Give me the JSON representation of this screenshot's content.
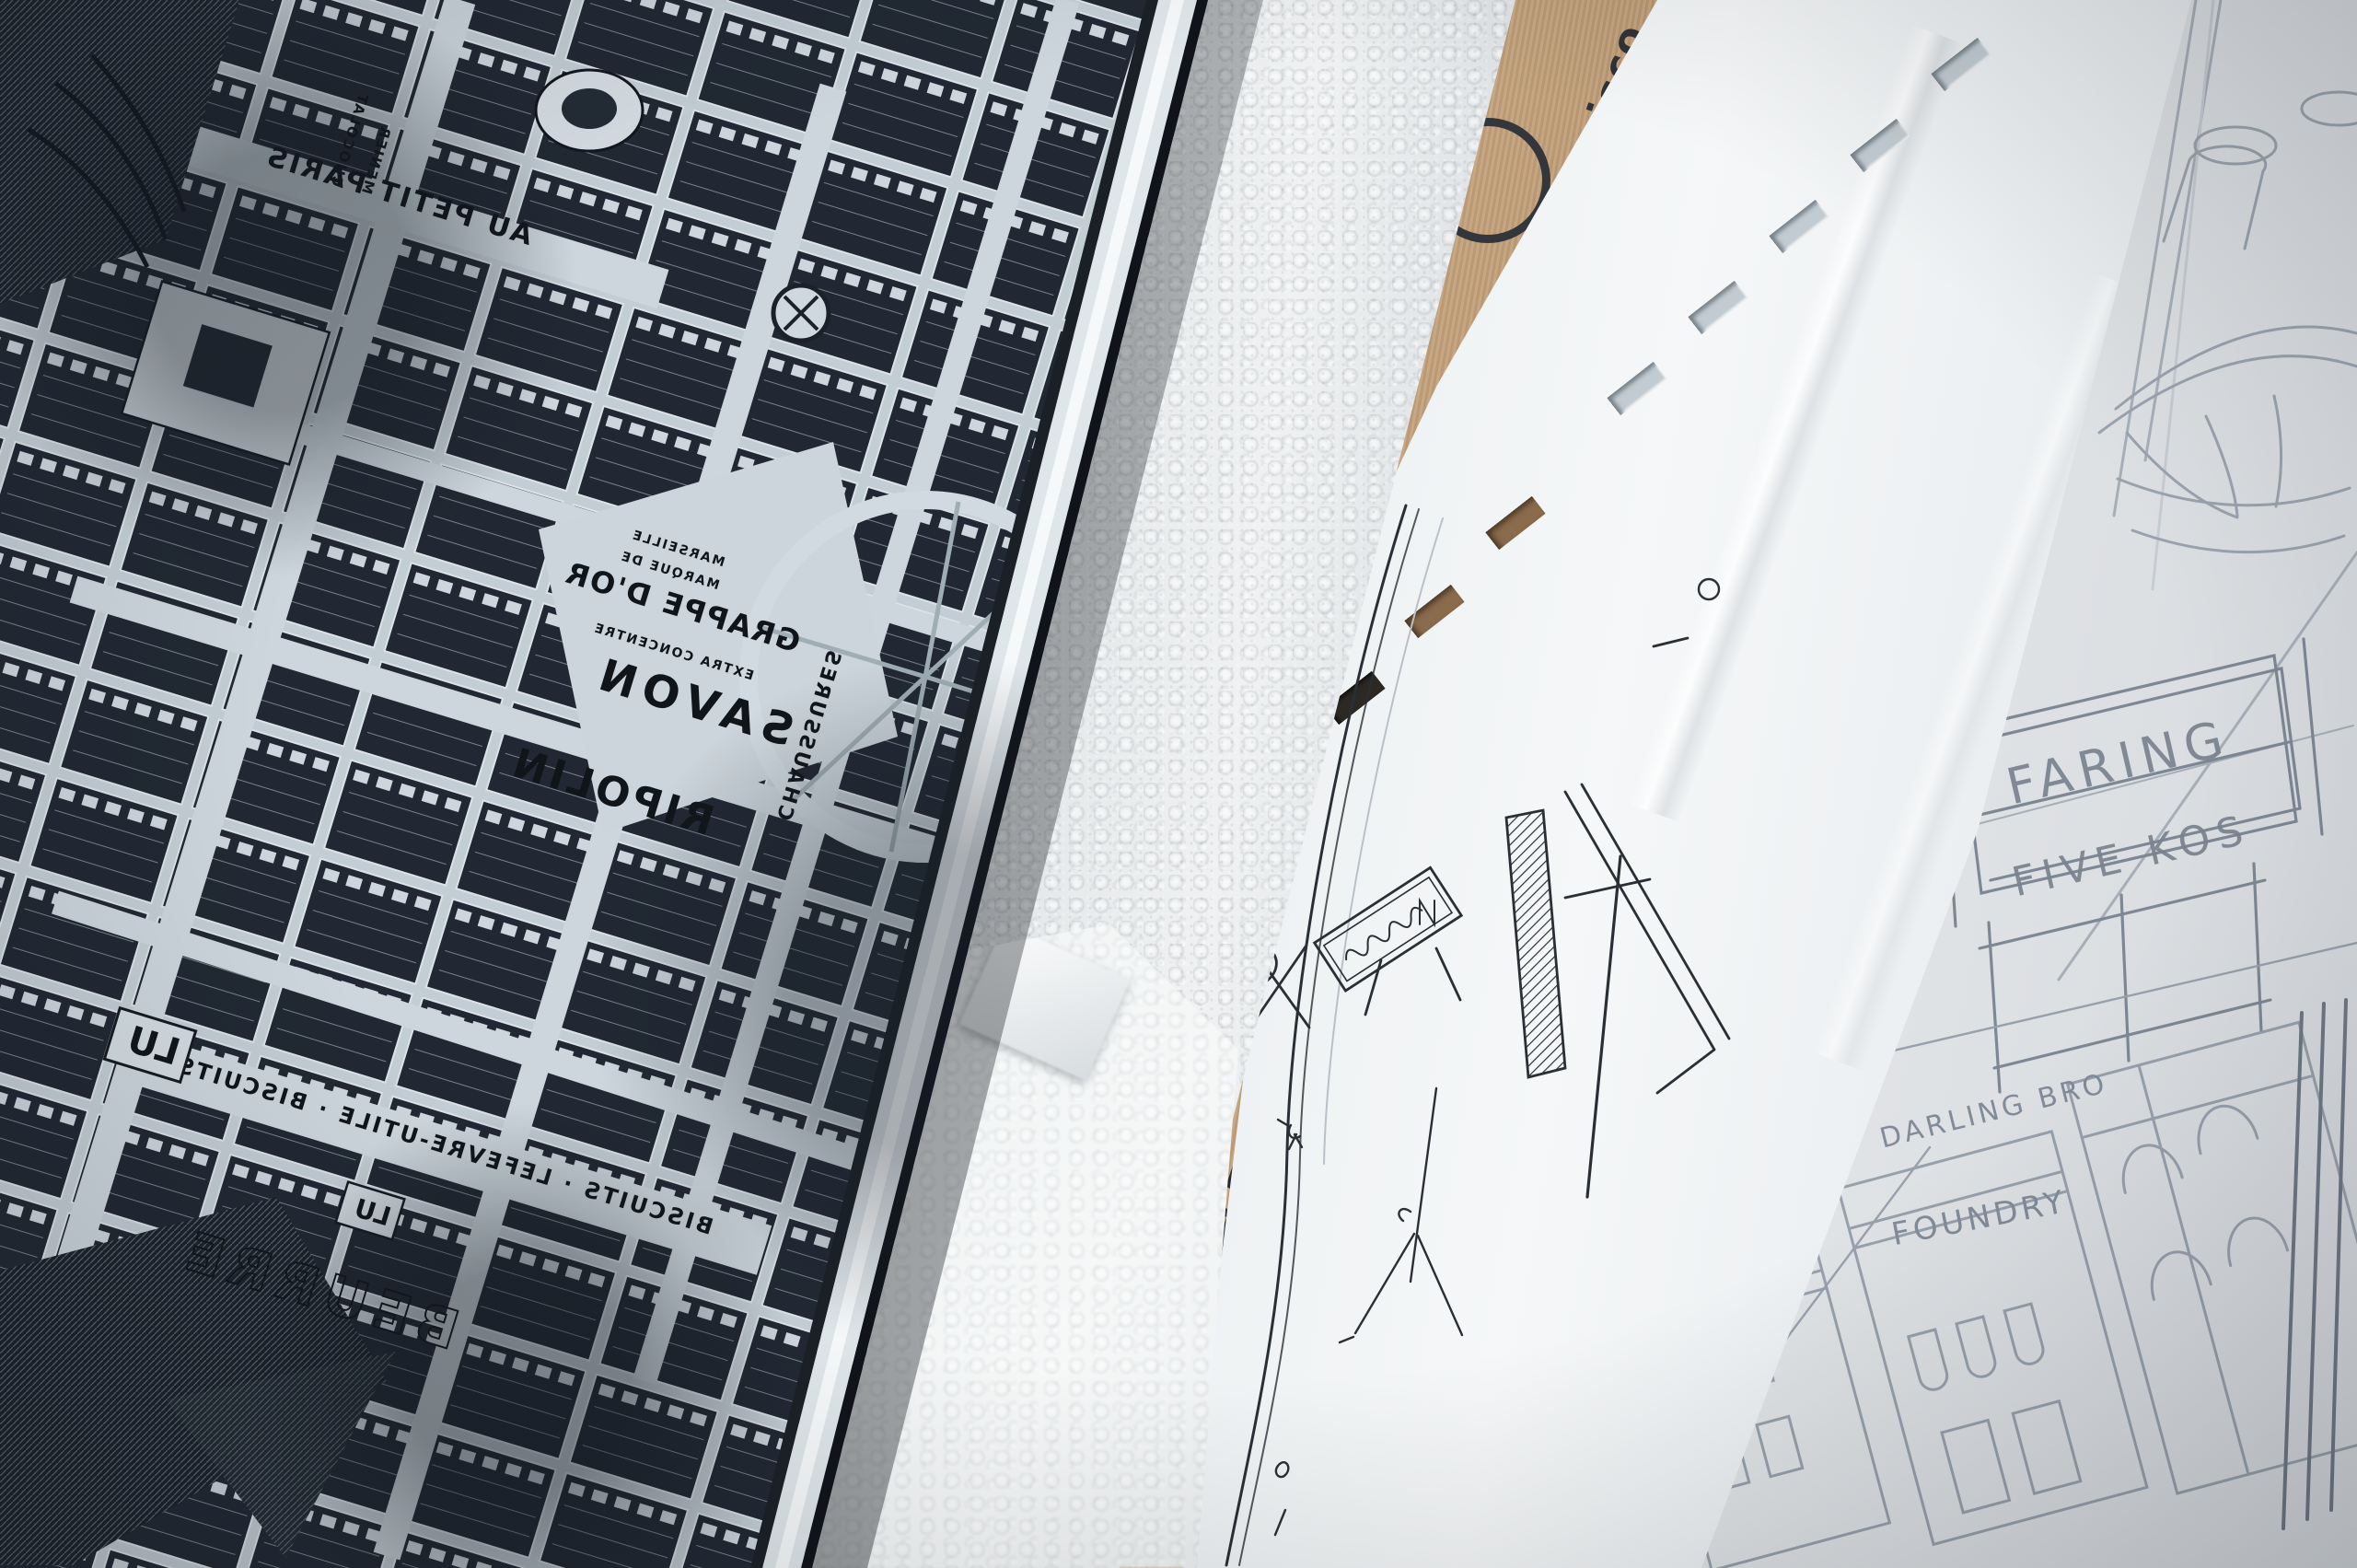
{
  "scene": {
    "description": "Overhead photo: an engraved metal printing plate of a vintage Paris city map (mirrored advertising lettering), beside a silver bubble-wrap roll, a kraft paper sleeve hand-lettered San Francisco with a round sanfrancisco stamp, a white die-cut sheet with an ink storefront sketch, and pencil sketches of Victorian storefronts",
    "colors": {
      "plate_dark": "#222933",
      "plate_street": "#c6cfd5",
      "bevel_light": "#f2f5f6",
      "bubble_dark": "#33383e",
      "bubble_light": "#eef1f2",
      "kraft": "#b8946e",
      "paper_white": "#f0f2f4",
      "sketch_paper": "#e8eaec",
      "pencil": "#8d97a3",
      "ink": "#2c3137",
      "marker": "#26292e"
    }
  },
  "plate": {
    "labels": {
      "au_petit_paris": "AU PETIT PARIS",
      "chocolat": "CHOCOLAT",
      "menier": "MENIER",
      "marseille": "MARSEILLE",
      "marque": "MARQUE DE",
      "grappe": "GRAPPE D'OR",
      "extra": "EXTRA CONCENTRE",
      "savon": "SAVON",
      "ripolin": "RIPOLIN",
      "chaussures": "CHAUSSURES",
      "biscuits": "BISCUITS · LEFEVRE-UTILE · BISCUITS",
      "lu_large": "LU",
      "lu_small": "LU",
      "beurre": "BEURRE"
    }
  },
  "kraft": {
    "handwritten": "San Francisco",
    "stamp": "sanfrancisco"
  },
  "sketch": {
    "sign_line1": "FARING",
    "sign_line2": "FIVE KOS",
    "label_darling": "DARLING BRO",
    "label_foundry": "FOUNDRY"
  }
}
